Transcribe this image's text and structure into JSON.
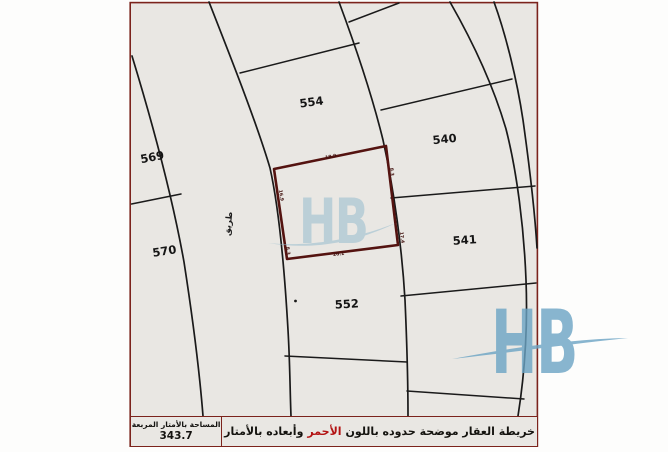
{
  "sheet": {
    "plots": {
      "p554": "554",
      "p569": "569",
      "p570": "570",
      "p540": "540",
      "p541": "541",
      "p552": "552"
    },
    "road_label": "طريق",
    "red_plot": {
      "dim_top": "18.9",
      "dim_bottom": "20.1",
      "dim_left": "16.9",
      "dim_right": "17.4",
      "dim_corner_tr": "8.3",
      "dim_corner_bl": "8.3"
    }
  },
  "watermark": {
    "text": "HB"
  },
  "footer": {
    "area_label": "المساحة بالأمتار المربعة",
    "area_value": "343.7",
    "caption_pre": "خريطة العقار موضحة حدوده باللون",
    "caption_red": "الأحمر",
    "caption_post": "وأبعاده بالأمتار"
  },
  "colors": {
    "sheet_background": "#e9e7e3",
    "sheet_border": "#7b231c",
    "boundary_line": "#1a1a1a",
    "red_plot_outline": "#541310",
    "caption_red": "#b31212",
    "watermark_blue_center": "#8fb8cc",
    "watermark_blue_corner": "#6ba4c4"
  }
}
